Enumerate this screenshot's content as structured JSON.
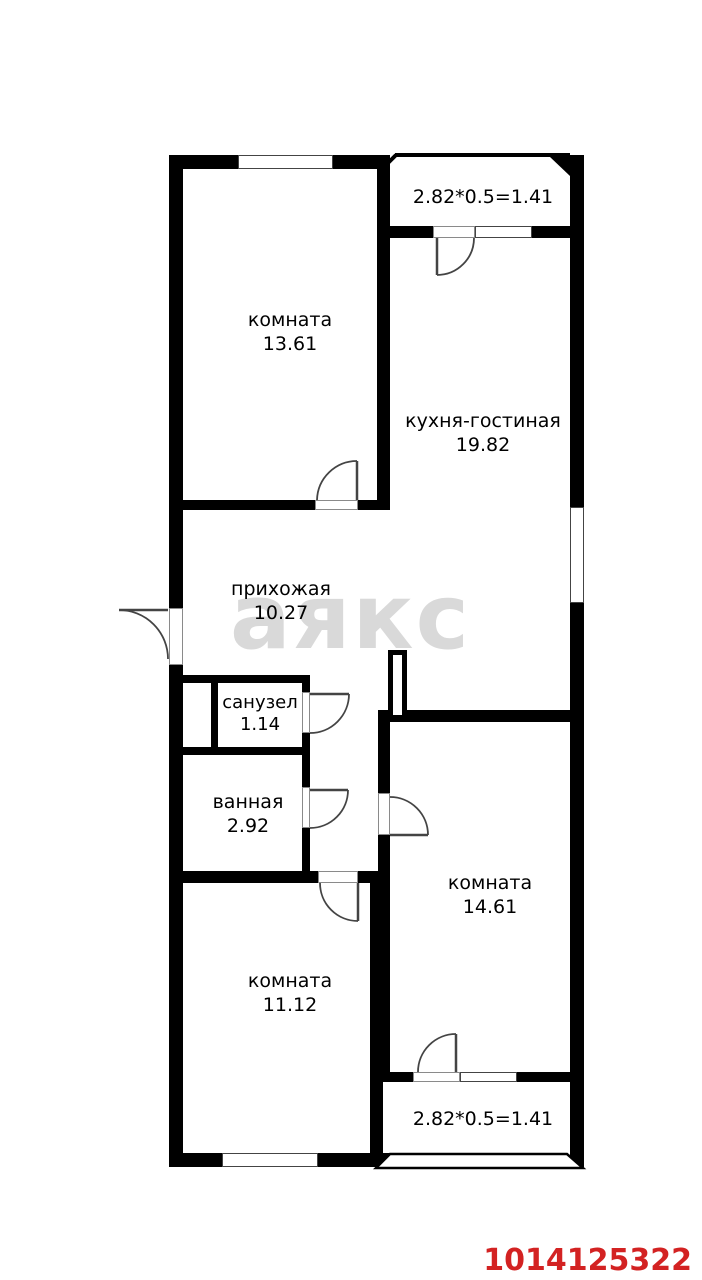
{
  "plan_type": "apartment floor plan",
  "colors": {
    "wall": "#000000",
    "background": "#ffffff",
    "watermark": "#d9d9d9",
    "listing_id": "#d32222",
    "door_line": "#444444"
  },
  "watermark": {
    "text": "аякс"
  },
  "listing_id": "1014125322",
  "rooms": [
    {
      "id": "room-top-left",
      "name": "комната",
      "area": "13.61"
    },
    {
      "id": "kitchen-living",
      "name": "кухня-гостиная",
      "area": "19.82"
    },
    {
      "id": "hallway",
      "name": "прихожая",
      "area": "10.27"
    },
    {
      "id": "wc",
      "name": "санузел",
      "area": "1.14"
    },
    {
      "id": "bathroom",
      "name": "ванная",
      "area": "2.92"
    },
    {
      "id": "room-bottom-left",
      "name": "комната",
      "area": "11.12"
    },
    {
      "id": "room-right",
      "name": "комната",
      "area": "14.61"
    }
  ],
  "balconies": [
    {
      "id": "balcony-top",
      "dimension": "2.82*0.5=1.41"
    },
    {
      "id": "balcony-bottom",
      "dimension": "2.82*0.5=1.41"
    }
  ]
}
